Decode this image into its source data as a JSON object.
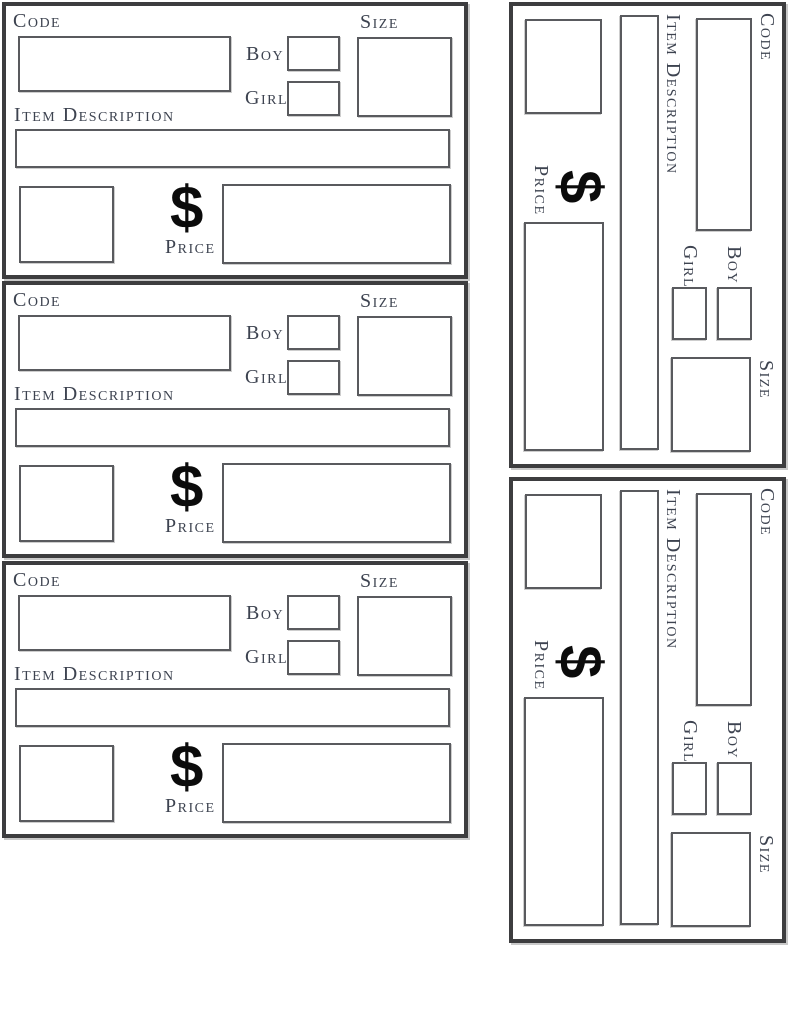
{
  "document": {
    "kind": "price-tag-template-sheet",
    "tag_count": 5
  },
  "labels": {
    "code": "Code",
    "boy": "Boy",
    "girl": "Girl",
    "size": "Size",
    "item_description": "Item Description",
    "currency": "$",
    "price": "Price"
  },
  "fields": {
    "code": "",
    "boy_check": "",
    "girl_check": "",
    "size": "",
    "item_description": "",
    "stub": "",
    "price": ""
  },
  "tags": [
    {
      "id": "tag-1",
      "orientation": "horizontal"
    },
    {
      "id": "tag-2",
      "orientation": "horizontal"
    },
    {
      "id": "tag-3",
      "orientation": "horizontal"
    },
    {
      "id": "tag-4",
      "orientation": "rotated-90-clockwise"
    },
    {
      "id": "tag-5",
      "orientation": "rotated-90-clockwise"
    }
  ],
  "colors": {
    "page_background": "#ffffff",
    "tag_border": "#3d3d3f",
    "box_border": "#595a5e",
    "label_text": "#3d4350",
    "dollar_sign": "#0b0b0b",
    "scan_shadow": "#c9c9c9"
  }
}
